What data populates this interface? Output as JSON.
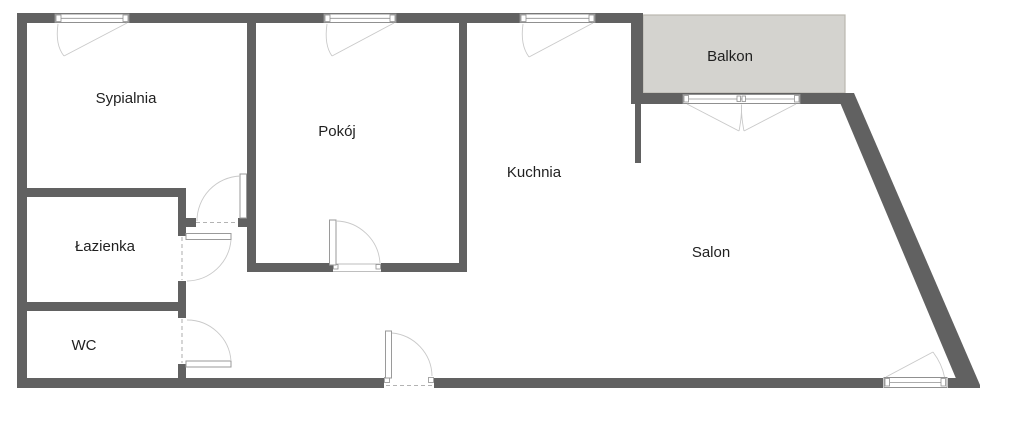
{
  "floorplan": {
    "type": "apartment-floor-plan",
    "rooms": {
      "sypialnia": "Sypialnia",
      "pokoj": "Pokój",
      "kuchnia": "Kuchnia",
      "salon": "Salon",
      "balkon": "Balkon",
      "lazienka": "Łazienka",
      "wc": "WC"
    },
    "colors": {
      "wall": "#616161",
      "balcony_fill": "#d4d3cf",
      "balcony_border": "#bab8af",
      "door_line": "#c9c9c9",
      "window_frame": "#909090",
      "threshold_dash": "#b3b3b3",
      "text": "#1f1f1f",
      "background": "#ffffff"
    }
  }
}
